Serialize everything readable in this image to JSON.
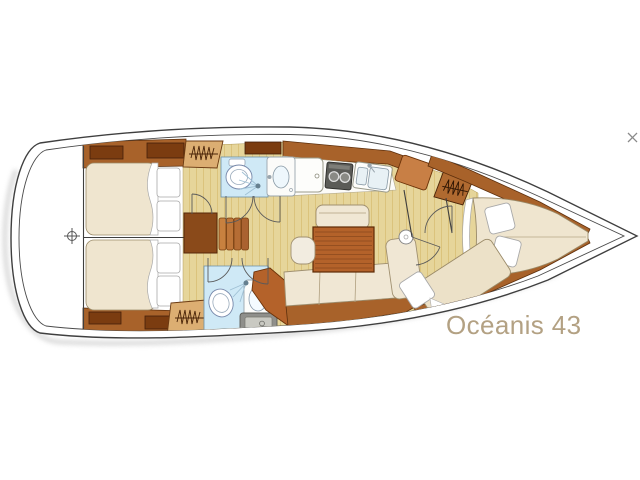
{
  "diagram": {
    "title": "Océanis 43",
    "title_color": "#b3a183",
    "icons": {
      "stern_datum": "⊕",
      "bow_tip_marker": "✕"
    },
    "depicted_features": [
      "rounded stern deck with datum mark",
      "two aft double berth cabins with lockers",
      "companionway steps",
      "port head with toilet, shower and washbasin",
      "starboard head with toilet, shower, washbasin and counter",
      "three hanging lockers (zigzag symbols)",
      "galley with fridge, two-burner stove and double sink",
      "salon with wooden table, bench, stool and L-shaped settee",
      "round side table",
      "starboard forward berth",
      "forward V-berth cabin with two pillows",
      "bow anchor locker"
    ],
    "palette": {
      "hull_outline": "#3f3f3f",
      "deck": "#ffffff",
      "floor": "#e6d59a",
      "floor_plank_line": "#caa850",
      "wood_trim": "#a8622a",
      "wood_dark": "#7b3c10",
      "furniture_wood": "#b4622a",
      "wardrobe_tan": "#dcae72",
      "mattress": "#efe5cf",
      "cushion": "#f0e7d4",
      "head_floor_blue": "#cfe9f6",
      "appliance_gray": "#5b5b57",
      "counter_gray": "#8f8f8b",
      "shadow": "#cfcfcf"
    }
  }
}
